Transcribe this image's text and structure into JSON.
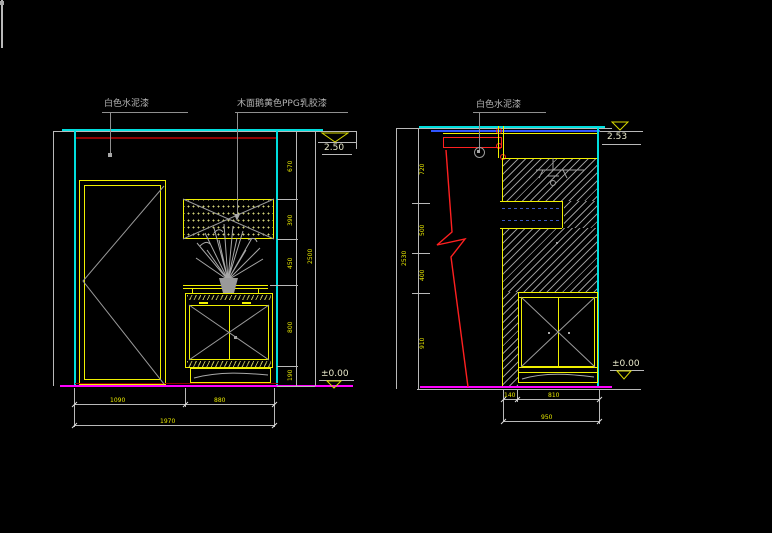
{
  "left": {
    "labels": {
      "wall_paint": "白色水泥漆",
      "panel_paint": "木面鹅黄色PPG乳胶漆"
    },
    "elevation": {
      "top": "2.50",
      "bottom": "±0.00"
    },
    "vdims": [
      "670",
      "390",
      "450",
      "800",
      "190"
    ],
    "vtotal": "2500",
    "hdims": [
      "1090",
      "880"
    ],
    "htotal": "1970"
  },
  "right": {
    "labels": {
      "wall_paint": "白色水泥漆"
    },
    "elevation": {
      "top": "2.53",
      "bottom": "±0.00"
    },
    "vdims": [
      "720",
      "500",
      "400",
      "910"
    ],
    "vtotal": "2530",
    "hdims": [
      "140",
      "810"
    ],
    "htotal": "950"
  },
  "icons": {
    "elevation_marker": "open-triangle-down",
    "leader_dot": "dot",
    "section_break": "red-zigzag"
  },
  "colors": {
    "background": "#000000",
    "outline_yellow": "#f0f000",
    "wall_cyan": "#00dede",
    "ceiling_blue": "#2f55ff",
    "section_red": "#ff2020",
    "dark_red": "#8f0000",
    "floor_magenta": "#ff00ff",
    "dim_text_yellow": "#e8e800",
    "label_gray": "#b5b5b5"
  }
}
